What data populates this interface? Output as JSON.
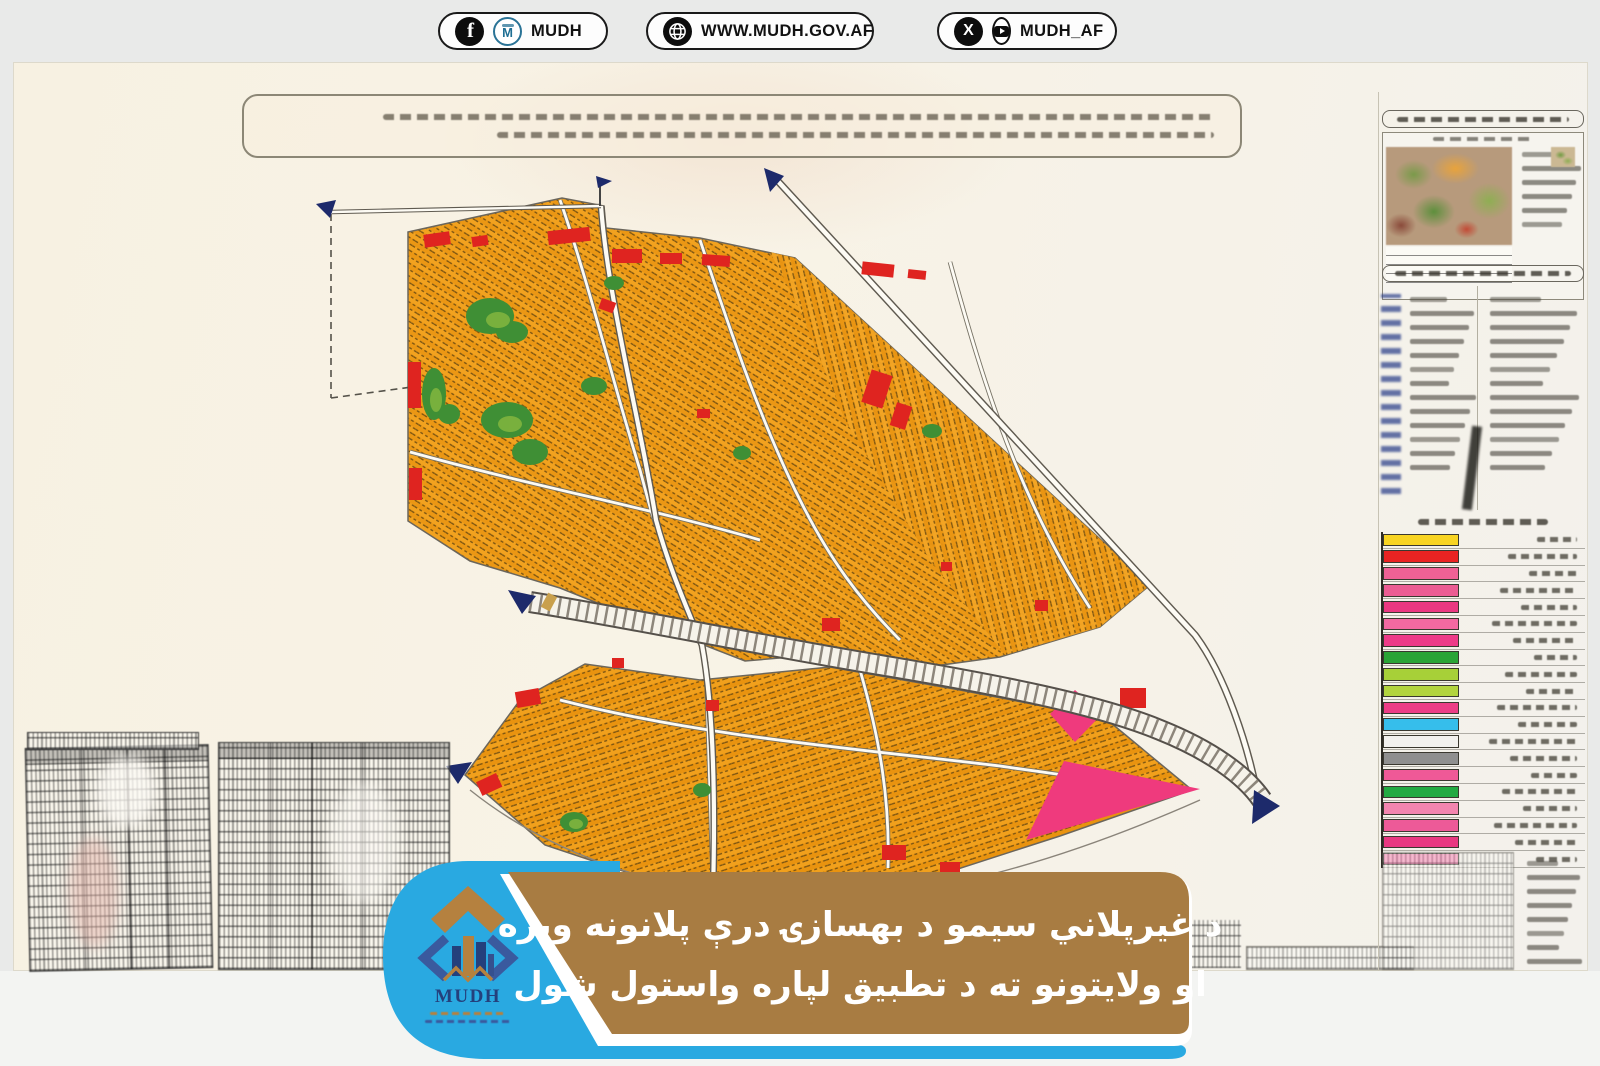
{
  "theme": {
    "pageBgTop": "#e9eae9",
    "pageBgBottom": "#f3f4f2",
    "paper": "#f8f3e6",
    "orange": "#f2a21f",
    "orangeDark": "#eb9714",
    "red": "#df2420",
    "pink": "#ef3a7d",
    "green": "#3f8f35",
    "greenLight": "#7fb43e",
    "navy": "#1d2a6b",
    "roadCasing": "#6b665c",
    "bannerBrown": "#a87c42",
    "brandBlue": "#29a9e1",
    "logoNavy": "#24407c",
    "logoTan": "#b5813f"
  },
  "header": {
    "pills": [
      {
        "id": "facebook",
        "label": "MUDH",
        "icons": [
          "facebook-icon",
          "mudh-emblem-icon"
        ]
      },
      {
        "id": "website",
        "label": "WWW.MUDH.GOV.AF",
        "icons": [
          "globe-icon"
        ]
      },
      {
        "id": "social",
        "label": "MUDH_AF",
        "icons": [
          "x-icon",
          "youtube-icon"
        ]
      }
    ]
  },
  "banner": {
    "line1": "د غیرپلاني سیمو د بهسازۍ درې پلانونه ویزه",
    "line2": "او ولایتونو ته د تطبیق لپاره واستول شول"
  },
  "logo": {
    "wordmark": "MUDH"
  },
  "map": {
    "legend_swatches": [
      "#f6d42a",
      "#e22524",
      "#ea6394",
      "#e75e92",
      "#e43a80",
      "#ee6ba0",
      "#e73d86",
      "#2ea23a",
      "#a8cf3e",
      "#b3d344",
      "#e63f85",
      "#3bbde8",
      "#f2f1ee",
      "#8f8f8f",
      "#ea5b96",
      "#27a845",
      "#ef86ae",
      "#e85c97",
      "#e23a80",
      "#ed6ba2"
    ]
  }
}
